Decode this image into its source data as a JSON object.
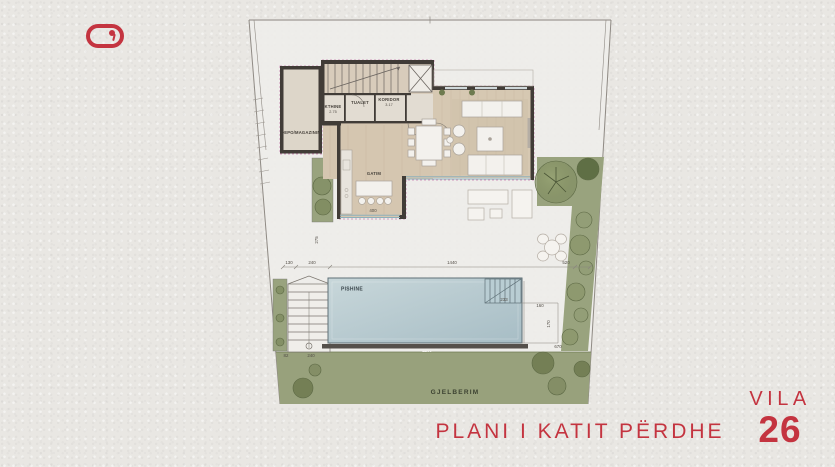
{
  "logo": {
    "name": "keyhole-pill-brand-mark",
    "color": "#c43440"
  },
  "footer": {
    "plan_title": "PLANI I KATIT PËRDHE",
    "villa_label": "VILA",
    "villa_number": "26",
    "accent_color": "#c43440"
  },
  "plan": {
    "labels": {
      "storage": "DEPO/MAGAZINIM",
      "corridor": "KORIDOR",
      "toilet": "TUALET",
      "utility": "KTHINE",
      "cooking": "GATIM",
      "pool": "PISHINE",
      "greenery": "GJELBERIM"
    },
    "areas": {
      "corridor": "3.17",
      "utility": "2.75"
    },
    "dimensions": {
      "left_offset": "130",
      "left_steps_width": "240",
      "terrace_width": "1440",
      "right_offset": "520",
      "terrace_depth": "275",
      "island_width": "400",
      "pool_length": "1200",
      "stair_bottom_left": "82",
      "stair_bottom_width": "240",
      "pool_steps_width": "233",
      "pool_side_a": "160",
      "pool_side_b": "170",
      "pool_right_width": "670"
    }
  },
  "colors": {
    "background": "#e9e7e3",
    "greenery": "#99a37e",
    "pool_water": "#b8cdd4",
    "floor_wood": "#d6c8b2",
    "walls": "#413c37",
    "accent_red": "#c43440",
    "insulation_dash": "#b85a9b"
  }
}
